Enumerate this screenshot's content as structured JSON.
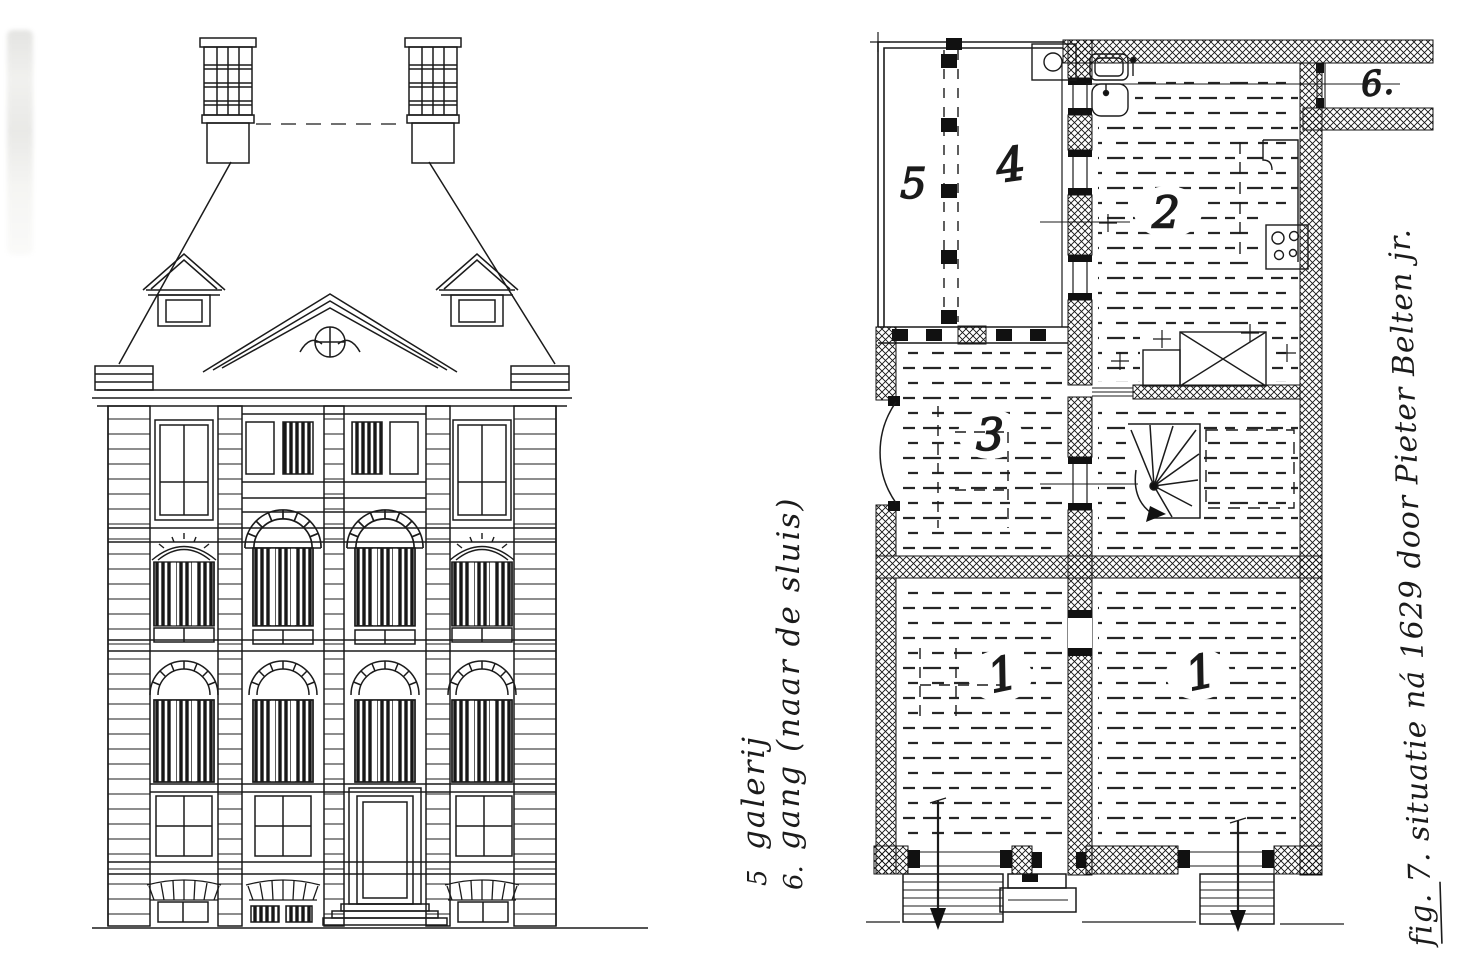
{
  "figure": {
    "plan_labels": {
      "room5": "5",
      "room4": "4",
      "room2": "2",
      "room3": "3",
      "room1_left": "1",
      "room1_right": "1",
      "corridor6": "6."
    },
    "legend": [
      {
        "number": "5",
        "text": "galerij"
      },
      {
        "number": "6.",
        "text": "gang (naar de sluis)"
      }
    ],
    "caption": "fig. 7.  situatie ná 1629 door Pieter Belten jr."
  }
}
